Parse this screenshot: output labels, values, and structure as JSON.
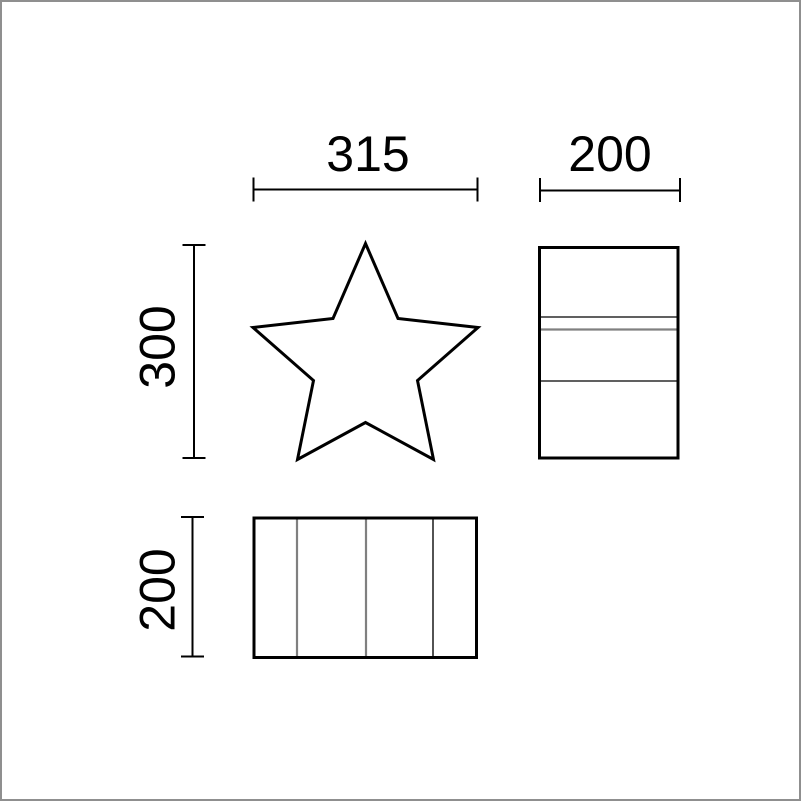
{
  "drawing": {
    "front_view": {
      "shape": "star",
      "width_label": "315",
      "height_label": "300"
    },
    "side_view": {
      "shape": "rectangle",
      "width_label": "200"
    },
    "top_view": {
      "shape": "rectangle",
      "height_label": "200"
    },
    "colors": {
      "primary_line": "#000000",
      "secondary_line": "#808080",
      "page_border": "#8f8f8f",
      "background": "#ffffff"
    }
  }
}
